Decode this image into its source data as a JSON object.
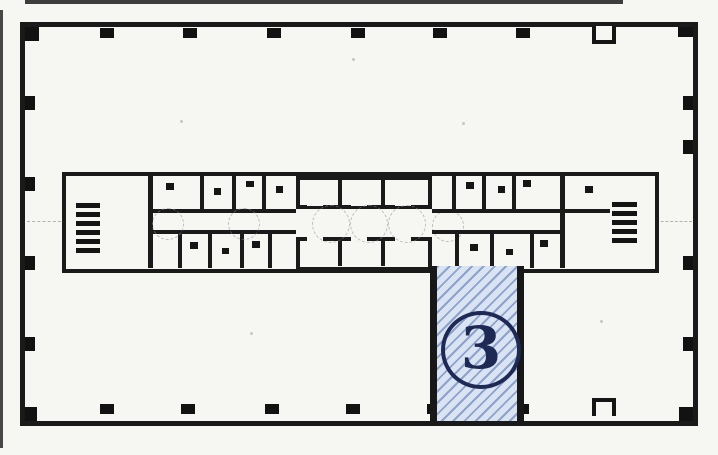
{
  "floor_plan": {
    "highlighted_unit": {
      "label": "3",
      "badge_style": "circled-number",
      "fill_pattern": "diagonal-hatch"
    }
  },
  "colors": {
    "wall": "#1a1a1a",
    "paper": "#f6f6f3",
    "highlight-fill": "#d9e3f1",
    "highlight-hatch": "#8ba3cc",
    "badge-ink": "#1e2a55"
  }
}
